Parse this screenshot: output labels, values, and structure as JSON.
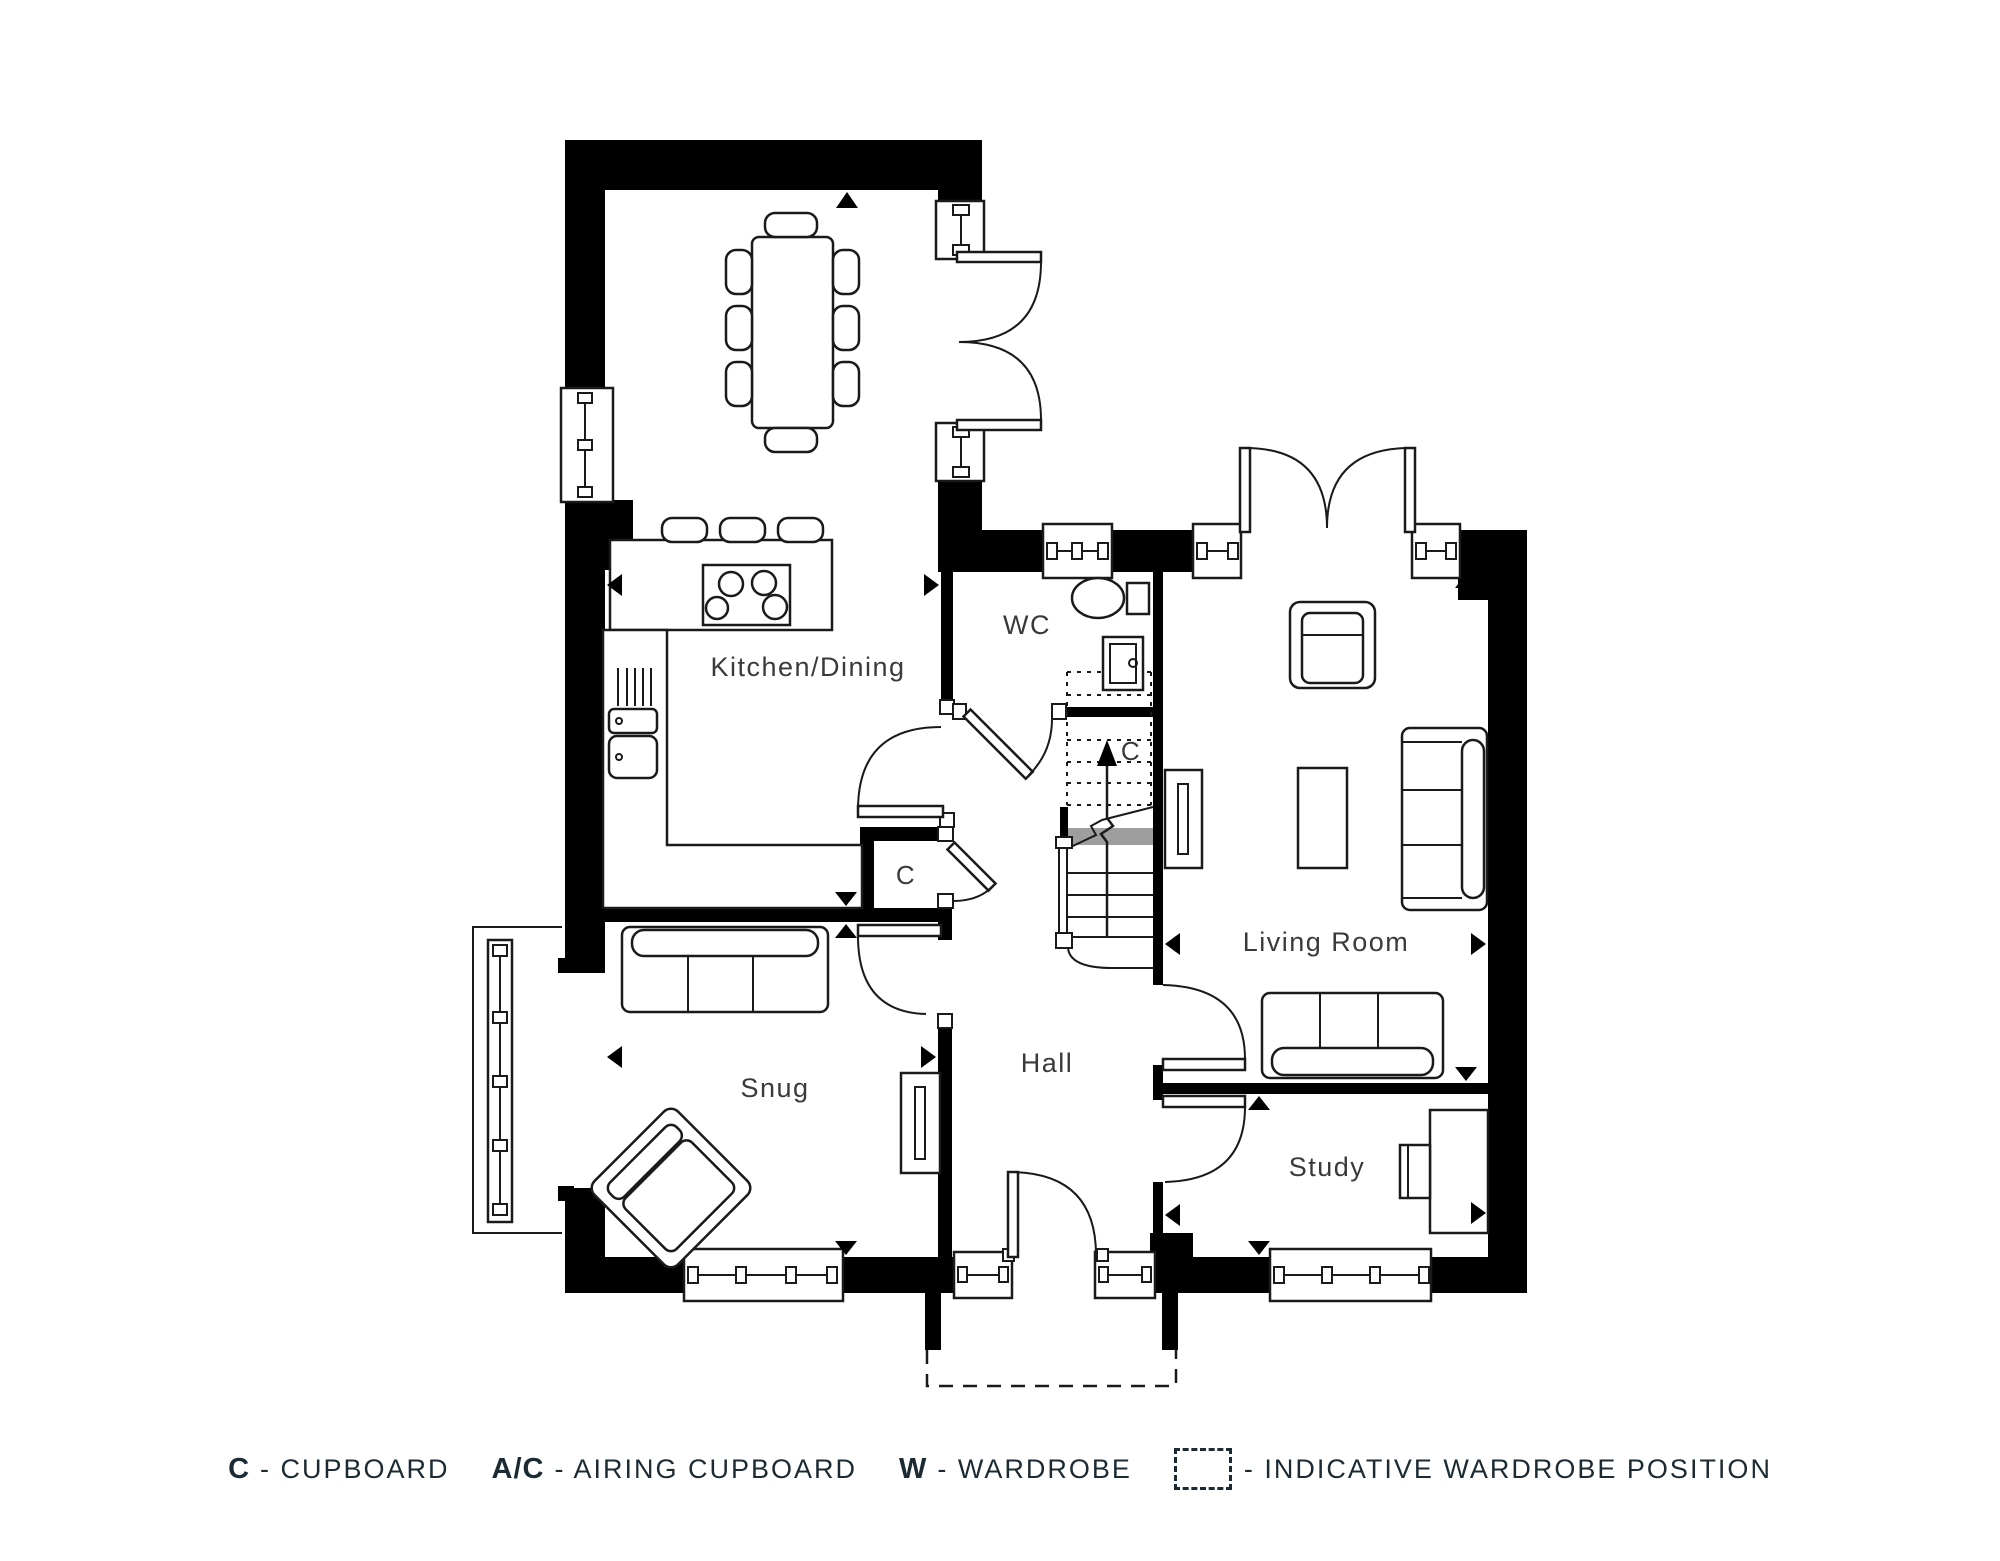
{
  "title": "House ground floor plan",
  "theme": {
    "ink": "#1c2b33",
    "line_color": "#1a1a1a",
    "wall_color": "#000000",
    "stair_break_grey": "#9e9e9e",
    "background": "#ffffff"
  },
  "labels": {
    "kitchen": "Kitchen/Dining",
    "wc": "WC",
    "living": "Living Room",
    "hall": "Hall",
    "snug": "Snug",
    "study": "Study",
    "cupboard_kitchen": "C",
    "cupboard_stairs": "C"
  },
  "icons": {
    "dimension_marker": "filled-triangle",
    "stairs_direction": "arrow-up",
    "indicative_wardrobe": "dashed-box"
  },
  "legend": {
    "items": [
      {
        "key": "C",
        "desc": "- CUPBOARD"
      },
      {
        "key": "A/C",
        "desc": "- AIRING CUPBOARD"
      },
      {
        "key": "W",
        "desc": "- WARDROBE"
      },
      {
        "key": "",
        "icon": "dashed-box",
        "desc": "- INDICATIVE WARDROBE POSITION"
      }
    ]
  }
}
